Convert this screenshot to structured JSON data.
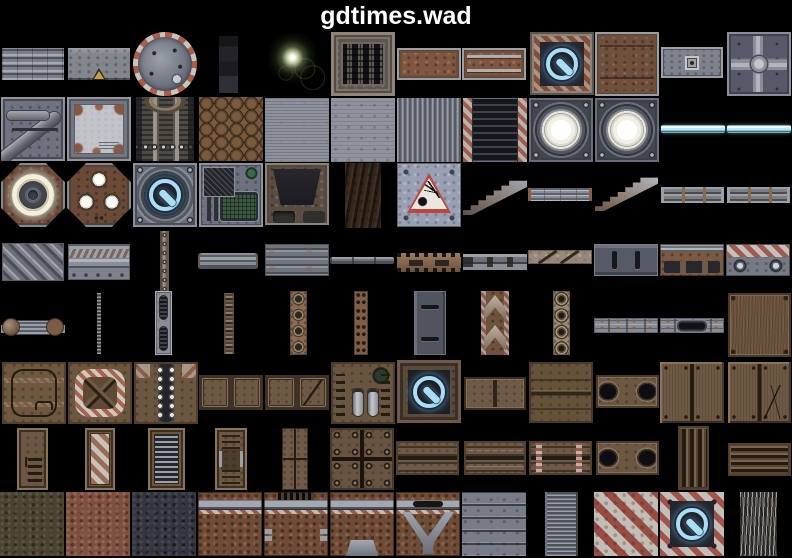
{
  "title": "gdtimes.wad",
  "background": "#000000",
  "accents": {
    "title_color": "#ffffff",
    "power_blue": "#a9def4",
    "hazard_red": "#a05a50",
    "hazard_silver": "#c0beb8",
    "lamp_white": "#ffffff",
    "lightbar_cyan": "#b2ecf8",
    "rust_brown": "#805640",
    "panel_brown": "#6e5a46",
    "metal_gray": "#8a8e98"
  },
  "atlas": {
    "columns": 12,
    "rows": 8,
    "cell_width": 66,
    "tiles": [
      {
        "n": "ribbed-bands",
        "s": "ribbed-bands",
        "x": 2,
        "y": 48,
        "w": 62,
        "h": 32
      },
      {
        "n": "warning-plate",
        "s": "plate-warning",
        "x": 68,
        "y": 48,
        "w": 62,
        "h": 32
      },
      {
        "n": "round-dial",
        "s": "dial",
        "x": 133,
        "y": 32,
        "w": 64,
        "h": 64
      },
      {
        "n": "dark-column",
        "s": "dark-strip",
        "x": 219,
        "y": 36,
        "w": 19,
        "h": 57
      },
      {
        "n": "light-flare",
        "s": "flare",
        "x": 269,
        "y": 34,
        "w": 56,
        "h": 56
      },
      {
        "n": "floor-grate",
        "s": "grate",
        "x": 331,
        "y": 32,
        "w": 64,
        "h": 64
      },
      {
        "n": "rust-plate",
        "s": "rust-plate",
        "x": 397,
        "y": 48,
        "w": 64,
        "h": 32
      },
      {
        "n": "rust-plate-bars",
        "s": "rust-plate-bars",
        "x": 462,
        "y": 48,
        "w": 64,
        "h": 32
      },
      {
        "n": "power-button-rust",
        "s": "power-rust",
        "x": 530,
        "y": 32,
        "w": 64,
        "h": 63
      },
      {
        "n": "rust-panel-framed",
        "s": "rust-panel",
        "x": 595,
        "y": 32,
        "w": 64,
        "h": 64
      },
      {
        "n": "small-plate",
        "s": "small-plate",
        "x": 661,
        "y": 47,
        "w": 62,
        "h": 31
      },
      {
        "n": "quad-dome-panel",
        "s": "quad-dome",
        "x": 727,
        "y": 32,
        "w": 64,
        "h": 64
      },
      {
        "n": "panel-with-pipe",
        "s": "panel-pipe",
        "x": 1,
        "y": 97,
        "w": 64,
        "h": 64
      },
      {
        "n": "torn-silver-plate",
        "s": "torn-plate",
        "x": 67,
        "y": 97,
        "w": 64,
        "h": 64
      },
      {
        "n": "engine-front",
        "s": "engine",
        "x": 136,
        "y": 97,
        "w": 58,
        "h": 64
      },
      {
        "n": "hex-tiles",
        "s": "hex-brown",
        "x": 199,
        "y": 97,
        "w": 64,
        "h": 64
      },
      {
        "n": "gray-ribbed-fine",
        "s": "gray-fine",
        "x": 265,
        "y": 98,
        "w": 64,
        "h": 64
      },
      {
        "n": "gray-plate",
        "s": "gray-plain",
        "x": 331,
        "y": 98,
        "w": 64,
        "h": 64
      },
      {
        "n": "corrugated-wall",
        "s": "corrugated",
        "x": 397,
        "y": 98,
        "w": 64,
        "h": 64
      },
      {
        "n": "vent-hazard",
        "s": "vent-hazard",
        "x": 463,
        "y": 98,
        "w": 64,
        "h": 64
      },
      {
        "n": "round-lamp",
        "s": "lamp",
        "x": 529,
        "y": 98,
        "w": 64,
        "h": 64
      },
      {
        "n": "round-lamp",
        "s": "lamp",
        "x": 595,
        "y": 98,
        "w": 64,
        "h": 64
      },
      {
        "n": "light-bar",
        "s": "lightbar",
        "x": 661,
        "y": 125,
        "w": 64,
        "h": 8
      },
      {
        "n": "light-bar",
        "s": "lightbar",
        "x": 727,
        "y": 125,
        "w": 64,
        "h": 8
      },
      {
        "n": "octagon-ring-light",
        "s": "octa-ring",
        "x": 1,
        "y": 163,
        "w": 64,
        "h": 64
      },
      {
        "n": "octagon-lights",
        "s": "octa-lights",
        "x": 67,
        "y": 163,
        "w": 64,
        "h": 64
      },
      {
        "n": "power-button-round",
        "s": "power-round",
        "x": 133,
        "y": 163,
        "w": 64,
        "h": 64
      },
      {
        "n": "console-screen",
        "s": "console",
        "x": 199,
        "y": 163,
        "w": 64,
        "h": 64
      },
      {
        "n": "dark-tech-panel",
        "s": "dark-tech",
        "x": 265,
        "y": 163,
        "w": 64,
        "h": 62
      },
      {
        "n": "rock-strip",
        "s": "bark",
        "x": 345,
        "y": 163,
        "w": 36,
        "h": 65
      },
      {
        "n": "explosive-sign",
        "s": "sign-explosive",
        "x": 397,
        "y": 163,
        "w": 64,
        "h": 64
      },
      {
        "n": "stairs-low",
        "s": "stairs-a",
        "x": 463,
        "y": 180,
        "w": 64,
        "h": 35
      },
      {
        "n": "thin-rail",
        "s": "rail-thin",
        "x": 528,
        "y": 188,
        "w": 64,
        "h": 13
      },
      {
        "n": "stairs-high",
        "s": "stairs-b",
        "x": 595,
        "y": 177,
        "w": 63,
        "h": 34
      },
      {
        "n": "rail-with-posts",
        "s": "rail-posts",
        "x": 661,
        "y": 187,
        "w": 63,
        "h": 16
      },
      {
        "n": "rail-with-posts",
        "s": "rail-posts",
        "x": 727,
        "y": 187,
        "w": 63,
        "h": 16
      },
      {
        "n": "diagonal-ribs",
        "s": "diag-ribbed",
        "x": 2,
        "y": 243,
        "w": 62,
        "h": 38
      },
      {
        "n": "pipe-bands",
        "s": "pipe-row",
        "x": 68,
        "y": 244,
        "w": 62,
        "h": 36
      },
      {
        "n": "vertical-pipe",
        "s": "pipe-vert",
        "x": 160,
        "y": 231,
        "w": 9,
        "h": 60
      },
      {
        "n": "pipe-segment",
        "s": "pipe-triband",
        "x": 198,
        "y": 253,
        "w": 60,
        "h": 16
      },
      {
        "n": "ribbed-plate",
        "s": "ribbed-plate",
        "x": 265,
        "y": 244,
        "w": 64,
        "h": 32
      },
      {
        "n": "thin-pipe",
        "s": "pipe-thin",
        "x": 330,
        "y": 257,
        "w": 64,
        "h": 7
      },
      {
        "n": "toothed-rail",
        "s": "cog-rail",
        "x": 397,
        "y": 253,
        "w": 64,
        "h": 19
      },
      {
        "n": "bracket-pipe",
        "s": "pipe-brackets",
        "x": 463,
        "y": 254,
        "w": 64,
        "h": 16
      },
      {
        "n": "slashed-bar",
        "s": "bar-slash",
        "x": 528,
        "y": 250,
        "w": 64,
        "h": 14
      },
      {
        "n": "slotted-plate",
        "s": "slot-plate",
        "x": 594,
        "y": 244,
        "w": 64,
        "h": 32
      },
      {
        "n": "rail-slot-plate",
        "s": "rail-slot",
        "x": 660,
        "y": 244,
        "w": 64,
        "h": 32
      },
      {
        "n": "hazard-bolt-plate",
        "s": "hazard-bolts",
        "x": 726,
        "y": 244,
        "w": 64,
        "h": 32
      },
      {
        "n": "pipe-coupling",
        "s": "coupling",
        "x": 1,
        "y": 318,
        "w": 64,
        "h": 19
      },
      {
        "n": "thin-chain",
        "s": "chain-thin",
        "x": 97,
        "y": 293,
        "w": 4,
        "h": 61
      },
      {
        "n": "slotted-strip",
        "s": "strip-slots",
        "x": 155,
        "y": 291,
        "w": 17,
        "h": 64
      },
      {
        "n": "chain-strip",
        "s": "chain",
        "x": 224,
        "y": 293,
        "w": 10,
        "h": 61
      },
      {
        "n": "rivet-strip",
        "s": "strip-rivets",
        "x": 290,
        "y": 291,
        "w": 17,
        "h": 64
      },
      {
        "n": "dotted-strip",
        "s": "strip-dots",
        "x": 354,
        "y": 291,
        "w": 14,
        "h": 64
      },
      {
        "n": "slotted-column",
        "s": "slot-plate-v",
        "x": 414,
        "y": 291,
        "w": 32,
        "h": 64
      },
      {
        "n": "chevron-strip",
        "s": "chevrons",
        "x": 481,
        "y": 291,
        "w": 28,
        "h": 64
      },
      {
        "n": "ring-strip",
        "s": "strip-rings",
        "x": 553,
        "y": 291,
        "w": 17,
        "h": 64
      },
      {
        "n": "riveted-band",
        "s": "band-rivets",
        "x": 594,
        "y": 318,
        "w": 64,
        "h": 15
      },
      {
        "n": "slot-band",
        "s": "band-slot",
        "x": 660,
        "y": 318,
        "w": 64,
        "h": 15
      },
      {
        "n": "leather-panel",
        "s": "leather",
        "x": 728,
        "y": 293,
        "w": 63,
        "h": 64
      },
      {
        "n": "door-outline",
        "s": "door-outline",
        "x": 2,
        "y": 362,
        "w": 64,
        "h": 62
      },
      {
        "n": "hazard-cross-panel",
        "s": "hazard-x",
        "x": 68,
        "y": 362,
        "w": 64,
        "h": 62
      },
      {
        "n": "spine-panel",
        "s": "spine",
        "x": 134,
        "y": 362,
        "w": 64,
        "h": 62
      },
      {
        "n": "two-panel",
        "s": "brown-2panel",
        "x": 199,
        "y": 375,
        "w": 64,
        "h": 35
      },
      {
        "n": "two-panel-diagonal",
        "s": "brown-2panel-diag",
        "x": 265,
        "y": 375,
        "w": 64,
        "h": 35
      },
      {
        "n": "tube-panel",
        "s": "tubes",
        "x": 331,
        "y": 362,
        "w": 64,
        "h": 62
      },
      {
        "n": "power-button-brown",
        "s": "power-brown",
        "x": 397,
        "y": 360,
        "w": 64,
        "h": 63
      },
      {
        "n": "four-panel",
        "s": "brown-4panel",
        "x": 464,
        "y": 377,
        "w": 62,
        "h": 33
      },
      {
        "n": "stacked-panels",
        "s": "brown-stack",
        "x": 529,
        "y": 362,
        "w": 64,
        "h": 61
      },
      {
        "n": "twin-holes-panel",
        "s": "holes2",
        "x": 596,
        "y": 375,
        "w": 63,
        "h": 33
      },
      {
        "n": "double-door",
        "s": "brown-doors",
        "x": 660,
        "y": 362,
        "w": 64,
        "h": 61
      },
      {
        "n": "double-door-crack",
        "s": "brown-doors-crack",
        "x": 728,
        "y": 362,
        "w": 63,
        "h": 61
      },
      {
        "n": "vent-door",
        "s": "door-vent",
        "x": 17,
        "y": 428,
        "w": 31,
        "h": 62
      },
      {
        "n": "hazard-door",
        "s": "door-hazard",
        "x": 85,
        "y": 428,
        "w": 30,
        "h": 62
      },
      {
        "n": "louver-door",
        "s": "door-louver",
        "x": 148,
        "y": 428,
        "w": 37,
        "h": 62
      },
      {
        "n": "machine-door",
        "s": "door-machine",
        "x": 215,
        "y": 428,
        "w": 32,
        "h": 62
      },
      {
        "n": "narrow-doors",
        "s": "door-pair",
        "x": 282,
        "y": 428,
        "w": 26,
        "h": 62
      },
      {
        "n": "bolted-quads",
        "s": "bolt4",
        "x": 330,
        "y": 428,
        "w": 64,
        "h": 62
      },
      {
        "n": "double-slats",
        "s": "slats2",
        "x": 396,
        "y": 441,
        "w": 63,
        "h": 34
      },
      {
        "n": "double-slats-lined",
        "s": "slats2-lines",
        "x": 464,
        "y": 441,
        "w": 62,
        "h": 34
      },
      {
        "n": "double-slats-hazard",
        "s": "slats2-hazard",
        "x": 529,
        "y": 441,
        "w": 63,
        "h": 34
      },
      {
        "n": "twin-holes-panel",
        "s": "holes2",
        "x": 596,
        "y": 441,
        "w": 63,
        "h": 34
      },
      {
        "n": "vertical-slats",
        "s": "vslats",
        "x": 678,
        "y": 426,
        "w": 31,
        "h": 64
      },
      {
        "n": "horizontal-slats",
        "s": "hslats",
        "x": 728,
        "y": 443,
        "w": 63,
        "h": 33
      },
      {
        "n": "rough-olive",
        "s": "rough-olive",
        "x": 0,
        "y": 492,
        "w": 64,
        "h": 64
      },
      {
        "n": "rough-rust",
        "s": "rough-rust",
        "x": 66,
        "y": 492,
        "w": 64,
        "h": 64
      },
      {
        "n": "rough-dark",
        "s": "rough-dark",
        "x": 132,
        "y": 492,
        "w": 64,
        "h": 64
      },
      {
        "n": "rust-wall-rail",
        "s": "rustwall",
        "x": 198,
        "y": 492,
        "w": 64,
        "h": 64
      },
      {
        "n": "rust-wall-vent",
        "s": "rustwall-vent",
        "x": 264,
        "y": 492,
        "w": 64,
        "h": 64
      },
      {
        "n": "rust-wall-base",
        "s": "rustwall-base",
        "x": 330,
        "y": 492,
        "w": 64,
        "h": 64
      },
      {
        "n": "rust-wall-strut",
        "s": "rustwall-strut",
        "x": 396,
        "y": 492,
        "w": 64,
        "h": 64
      },
      {
        "n": "metal-planks",
        "s": "planks",
        "x": 462,
        "y": 492,
        "w": 64,
        "h": 64
      },
      {
        "n": "fine-slat-strip",
        "s": "finslat",
        "x": 545,
        "y": 492,
        "w": 33,
        "h": 64
      },
      {
        "n": "hazard-stripes",
        "s": "hazard-diag",
        "x": 594,
        "y": 492,
        "w": 64,
        "h": 64
      },
      {
        "n": "power-button-hazard",
        "s": "power-hazard",
        "x": 660,
        "y": 492,
        "w": 64,
        "h": 64
      },
      {
        "n": "cable-strip",
        "s": "wires",
        "x": 740,
        "y": 492,
        "w": 37,
        "h": 64
      }
    ]
  }
}
